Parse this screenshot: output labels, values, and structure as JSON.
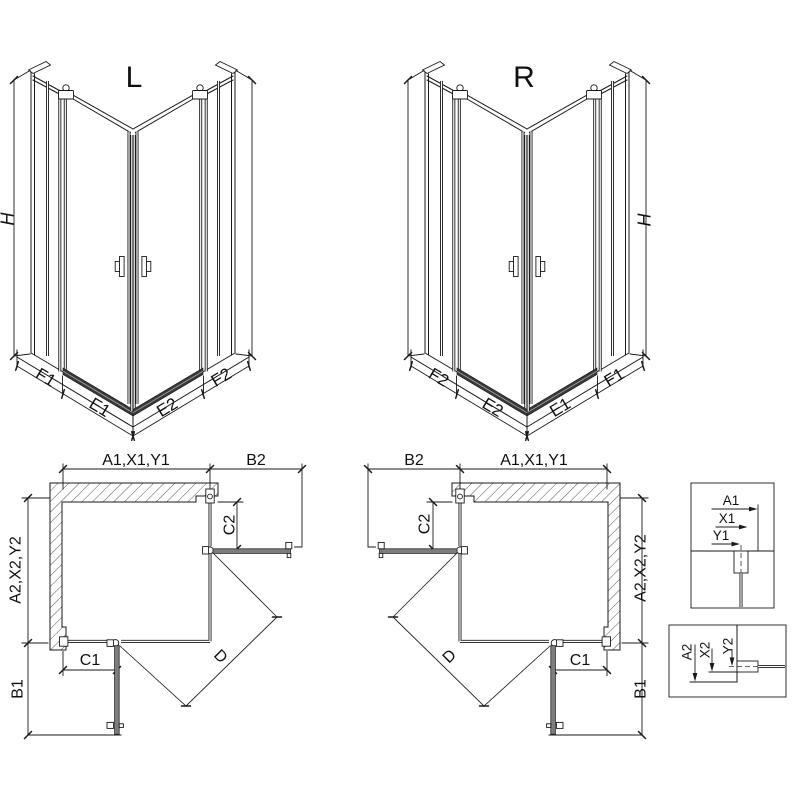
{
  "views": {
    "iso_left": {
      "title": "L",
      "dims": {
        "height": "H",
        "panels": [
          "F1",
          "E1",
          "E2",
          "F2"
        ]
      }
    },
    "iso_right": {
      "title": "R",
      "dims": {
        "height": "H",
        "panels": [
          "F2",
          "E2",
          "E1",
          "F1"
        ]
      }
    },
    "plan_left": {
      "dims": {
        "top": "A1,X1,Y1",
        "door_open_top": "B2",
        "fixed_side": "C2",
        "side": "A2,X2,Y2",
        "fixed_bottom": "C1",
        "door_open_bottom": "B1",
        "diagonal_entry": "D"
      }
    },
    "plan_right": {
      "dims": {
        "top": "A1,X1,Y1",
        "door_open_top": "B2",
        "fixed_side": "C2",
        "side": "A2,X2,Y2",
        "fixed_bottom": "C1",
        "door_open_bottom": "B1",
        "diagonal_entry": "D"
      }
    },
    "detail_top": {
      "dims": [
        "A1",
        "X1",
        "Y1"
      ]
    },
    "detail_bottom": {
      "dims": [
        "A2",
        "X2",
        "Y2"
      ]
    }
  },
  "colors": {
    "line": "#1a1a1a",
    "panel_gray": "#7d7d7d",
    "rail_dark": "#3a3a3a",
    "background": "#ffffff"
  }
}
